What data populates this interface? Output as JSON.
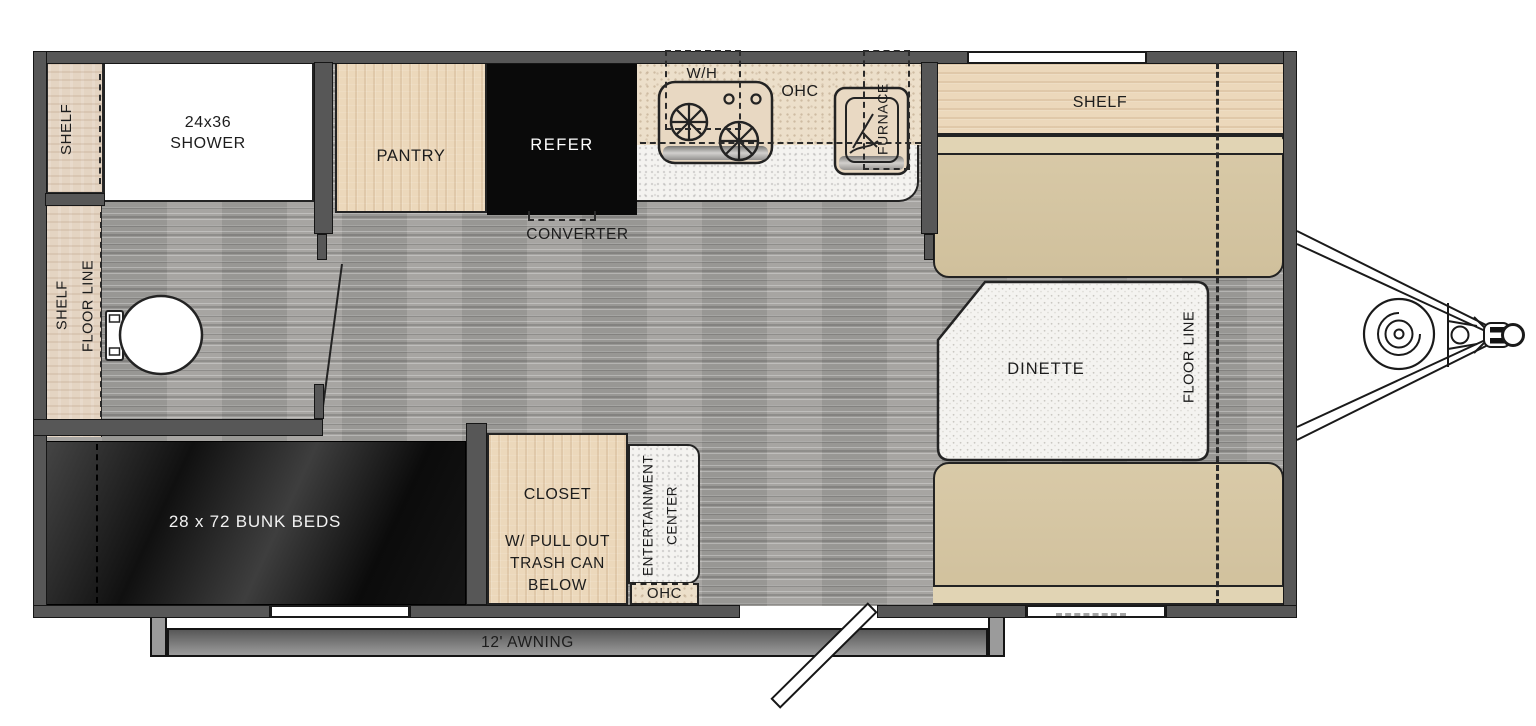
{
  "labels": {
    "shelf_top_left": "SHELF",
    "shower_line1": "24x36",
    "shower_line2": "SHOWER",
    "pantry": "PANTRY",
    "refer": "REFER",
    "converter": "CONVERTER",
    "water_heater": "W/H",
    "ohc_kitchen": "OHC",
    "furnace": "FURNACE",
    "shelf_front": "SHELF",
    "dinette": "DINETTE",
    "floor_line_front": "FLOOR LINE",
    "shelf_bath": "SHELF",
    "floor_line_bath": "FLOOR LINE",
    "bunk_beds": "28 x 72 BUNK BEDS",
    "closet_line1": "CLOSET",
    "closet_line2": "W/ PULL OUT",
    "closet_line3": "TRASH CAN",
    "closet_line4": "BELOW",
    "ent_center_line1": "ENTERTAINMENT",
    "ent_center_line2": "CENTER",
    "ohc_entry": "OHC",
    "awning": "12' AWNING"
  },
  "colors": {
    "wall": "#575757",
    "outline": "#232323",
    "text": "#1c1c1c",
    "wood": "#ecd8bb",
    "wood_light": "#e4d4c2",
    "counter_beige": "#ecdfca",
    "counter_white": "#f4f3f0",
    "bench": "#d6c7a4",
    "bench_lip": "#e1d4b4",
    "floor": "#a2a09d",
    "appliance_black": "#0a0a0a",
    "awning_gray": "#8a8a8a",
    "bunk_text": "#f2f2f2",
    "refer_text": "#ffffff"
  }
}
